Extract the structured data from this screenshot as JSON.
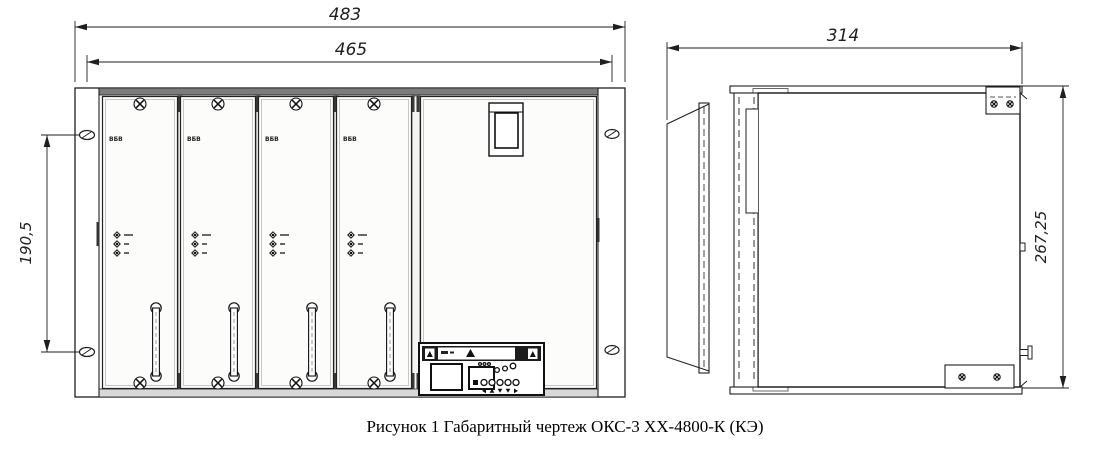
{
  "figure": {
    "caption": "Рисунок 1 Габаритный чертеж ОКС-3 ХХ-4800-К (КЭ)"
  },
  "front_view": {
    "dim_overall_width": "483",
    "dim_inner_width": "465",
    "dim_mounting_height": "190,5",
    "module_label": "ВБВ",
    "module_count": 4
  },
  "side_view": {
    "dim_depth": "314",
    "dim_height": "267,25"
  },
  "colors": {
    "line": "#1f1f1f",
    "background": "#ffffff"
  }
}
